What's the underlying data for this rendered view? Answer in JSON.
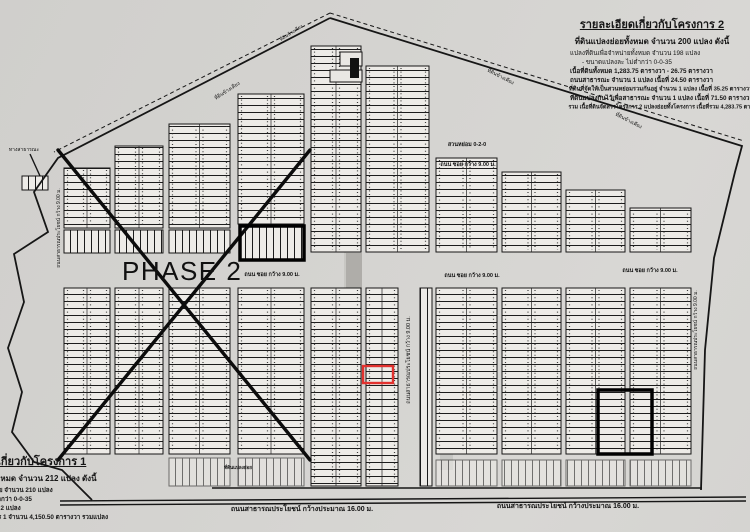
{
  "document": {
    "phase_label": "PHASE 2",
    "project2_details": {
      "title": "รายละเอียดเกี่ยวกับโครงการ 2",
      "subtitle": "ที่ดินแปลงย่อยทั้งหมด จำนวน 200 แปลง ดังนี้",
      "lines": [
        "แปลงที่ดินเพื่อจำหน่ายทั้งหมด จำนวน 198 แปลง",
        "- ขนาดแปลงละ ไม่ต่ำกว่า 0-0-35",
        "เนื้อที่ดินทั้งหมด 1,283.75 ตารางวา - 26.75 ตารางวา",
        "ถนนสาธารณะ จำนวน 1 แปลง เนื้อที่ 24.50 ตารางวา",
        "ที่ดินที่จัดให้เป็นสวนหย่อมรวมกันอยู่ จำนวน 1 แปลง เนื้อที่ 35.25 ตารางวา",
        "ที่ดินแปลงกันไว้เพื่อสาธารณะ จำนวน 1 แปลง เนื้อที่ 71.50 ตารางวา",
        "รวม เนื้อที่ดินจัดสรรโครงการ 2 แปลงย่อยทั้งโครงการ เนื้อที่รวม 4,283.75 ตารางวา"
      ]
    },
    "project1_details": {
      "title": "รายละเอียดเกี่ยวกับโครงการ 1",
      "subtitle": "ที่ดินแปลงย่อยทั้งหมด จำนวน 212 แปลง ดังนี้",
      "lines": [
        "แปลงที่ดินเพื่อจำหน่าย จำนวน 210 แปลง",
        "- ขนาดแปลงละ ไม่ต่ำกว่า 0-0-35",
        "ที่ดินแปลงอื่น จำนวน 2 แปลง",
        "รวม เนื้อที่ทั้งโครงการ 1 จำนวน 4,150.50 ตารางวา รวมแปลง"
      ]
    }
  },
  "map": {
    "colors": {
      "paper": "#d3d2cf",
      "ink": "#161616",
      "lot_fill": "#edebe7",
      "red": "#e2312e"
    },
    "boundary": {
      "solid": [
        "330,18 742,146 735,172 714,258 705,350 701,490",
        "330,18 58,158 34,192 48,232 14,254 24,302 8,348 22,392 12,432 34,462 62,470 92,500"
      ],
      "dashed": [
        "330,13 744,141",
        "330,13 54,152"
      ]
    },
    "blocks": [
      {
        "x": 64,
        "y": 168,
        "w": 46,
        "h": 60,
        "t": "h"
      },
      {
        "x": 64,
        "y": 230,
        "w": 46,
        "h": 23,
        "t": "v"
      },
      {
        "x": 115,
        "y": 146,
        "w": 48,
        "h": 82,
        "t": "h"
      },
      {
        "x": 115,
        "y": 230,
        "w": 48,
        "h": 23,
        "t": "v"
      },
      {
        "x": 169,
        "y": 124,
        "w": 61,
        "h": 104,
        "t": "h"
      },
      {
        "x": 169,
        "y": 230,
        "w": 61,
        "h": 23,
        "t": "v"
      },
      {
        "x": 238,
        "y": 94,
        "w": 66,
        "h": 130,
        "t": "h"
      },
      {
        "x": 240,
        "y": 226,
        "w": 64,
        "h": 34,
        "t": "v"
      },
      {
        "x": 311,
        "y": 46,
        "w": 50,
        "h": 206,
        "t": "h"
      },
      {
        "x": 366,
        "y": 66,
        "w": 63,
        "h": 186,
        "t": "h"
      },
      {
        "x": 436,
        "y": 158,
        "w": 61,
        "h": 94,
        "t": "h"
      },
      {
        "x": 502,
        "y": 172,
        "w": 59,
        "h": 80,
        "t": "h"
      },
      {
        "x": 566,
        "y": 190,
        "w": 59,
        "h": 62,
        "t": "h"
      },
      {
        "x": 630,
        "y": 208,
        "w": 61,
        "h": 44,
        "t": "h"
      },
      {
        "x": 64,
        "y": 288,
        "w": 46,
        "h": 166,
        "t": "h"
      },
      {
        "x": 115,
        "y": 288,
        "w": 48,
        "h": 166,
        "t": "h"
      },
      {
        "x": 169,
        "y": 288,
        "w": 61,
        "h": 166,
        "t": "h"
      },
      {
        "x": 238,
        "y": 288,
        "w": 66,
        "h": 166,
        "t": "h"
      },
      {
        "x": 311,
        "y": 288,
        "w": 50,
        "h": 198,
        "t": "h"
      },
      {
        "x": 366,
        "y": 288,
        "w": 32,
        "h": 198,
        "t": "h"
      },
      {
        "x": 420,
        "y": 288,
        "w": 12,
        "h": 198,
        "t": "v"
      },
      {
        "x": 436,
        "y": 288,
        "w": 61,
        "h": 166,
        "t": "h"
      },
      {
        "x": 502,
        "y": 288,
        "w": 59,
        "h": 166,
        "t": "h"
      },
      {
        "x": 566,
        "y": 288,
        "w": 59,
        "h": 166,
        "t": "h"
      },
      {
        "x": 630,
        "y": 288,
        "w": 61,
        "h": 166,
        "t": "h"
      },
      {
        "x": 169,
        "y": 458,
        "w": 61,
        "h": 28,
        "t": "v",
        "light": true
      },
      {
        "x": 238,
        "y": 458,
        "w": 66,
        "h": 28,
        "t": "v",
        "light": true
      },
      {
        "x": 436,
        "y": 460,
        "w": 61,
        "h": 26,
        "t": "v",
        "light": true
      },
      {
        "x": 502,
        "y": 460,
        "w": 59,
        "h": 26,
        "t": "v",
        "light": true
      },
      {
        "x": 566,
        "y": 460,
        "w": 59,
        "h": 26,
        "t": "v",
        "light": true
      },
      {
        "x": 630,
        "y": 460,
        "w": 61,
        "h": 26,
        "t": "v",
        "light": true
      },
      {
        "x": 22,
        "y": 176,
        "w": 26,
        "h": 14,
        "t": "v"
      },
      {
        "x": 340,
        "y": 52,
        "w": 22,
        "h": 14,
        "t": "plain"
      },
      {
        "x": 330,
        "y": 70,
        "w": 32,
        "h": 12,
        "t": "plain"
      }
    ],
    "bold_rects": [
      {
        "x": 240,
        "y": 226,
        "w": 64,
        "h": 34
      },
      {
        "x": 598,
        "y": 390,
        "w": 54,
        "h": 64
      }
    ],
    "red_rect": {
      "x": 363,
      "y": 366,
      "w": 30,
      "h": 17
    },
    "x_lines": [
      [
        58,
        150,
        310,
        460
      ],
      [
        58,
        460,
        310,
        150
      ]
    ],
    "road_lines": [
      [
        212,
        488,
        702,
        488
      ],
      [
        60,
        501,
        746,
        497
      ],
      [
        60,
        505,
        746,
        501
      ],
      [
        30,
        154,
        40,
        176
      ]
    ],
    "marks": [
      {
        "x": 350,
        "y": 58,
        "w": 9,
        "h": 20
      }
    ],
    "smudges": [
      {
        "x": 344,
        "y": 200,
        "w": 18,
        "h": 110,
        "o": 0.1
      },
      {
        "x": 346,
        "y": 253,
        "w": 16,
        "h": 36,
        "o": 0.22
      },
      {
        "x": 440,
        "y": 300,
        "w": 13,
        "h": 170,
        "o": 0.12
      }
    ],
    "labels": [
      {
        "text": "ถนนสาธารณประโยชน์ กว้างประมาณ 16.00 ม.",
        "x": 302,
        "y": 511,
        "size": 7,
        "bold": true
      },
      {
        "text": "ถนนสาธารณประโยชน์ กว้างประมาณ 16.00 ม.",
        "x": 568,
        "y": 508,
        "size": 7,
        "bold": true
      },
      {
        "text": "ถนน ซอย กว้าง 9.00 ม.",
        "x": 272,
        "y": 276,
        "size": 5.5,
        "bold": true
      },
      {
        "text": "ถนน ซอย กว้าง 9.00 ม.",
        "x": 472,
        "y": 277,
        "size": 5.5,
        "bold": true
      },
      {
        "text": "ถนน ซอย กว้าง 9.00 ม.",
        "x": 650,
        "y": 272,
        "size": 5.5,
        "bold": true
      },
      {
        "text": "ถนน ซอย กว้าง 9.00 ม.",
        "x": 468,
        "y": 166,
        "size": 5.5,
        "bold": true
      },
      {
        "text": "สวนหย่อม 0-2-0",
        "x": 467,
        "y": 146,
        "size": 5.5,
        "bold": true
      },
      {
        "text": "ถนนสาธารณประโยชน์ กว้าง 9.00 ม.",
        "x": 60,
        "y": 228,
        "rot": -90,
        "size": 5
      },
      {
        "text": "ถนนสาธารณประโยชน์ กว้าง 9.00 ม.",
        "x": 410,
        "y": 360,
        "rot": -90,
        "size": 5.5
      },
      {
        "text": "ถนนสาธารณประโยชน์ กว้าง 9.00 ม.",
        "x": 697,
        "y": 330,
        "rot": -90,
        "size": 5
      },
      {
        "text": "ที่ดินข้างเคียง",
        "x": 228,
        "y": 92,
        "rot": -33,
        "size": 5
      },
      {
        "text": "ที่ดินข้างเคียง",
        "x": 500,
        "y": 78,
        "rot": 27,
        "size": 5
      },
      {
        "text": "ที่ดินข้างเคียง",
        "x": 628,
        "y": 122,
        "rot": 27,
        "size": 5
      },
      {
        "text": "ที่ดินข้างเคียง",
        "x": 292,
        "y": 34,
        "rot": -33,
        "size": 4.5
      },
      {
        "text": "ทางสาธารณะ",
        "x": 24,
        "y": 151,
        "size": 5
      },
      {
        "text": "ที่ดินแปลงย่อย",
        "x": 238,
        "y": 469,
        "size": 4.5,
        "bold": true
      }
    ]
  }
}
